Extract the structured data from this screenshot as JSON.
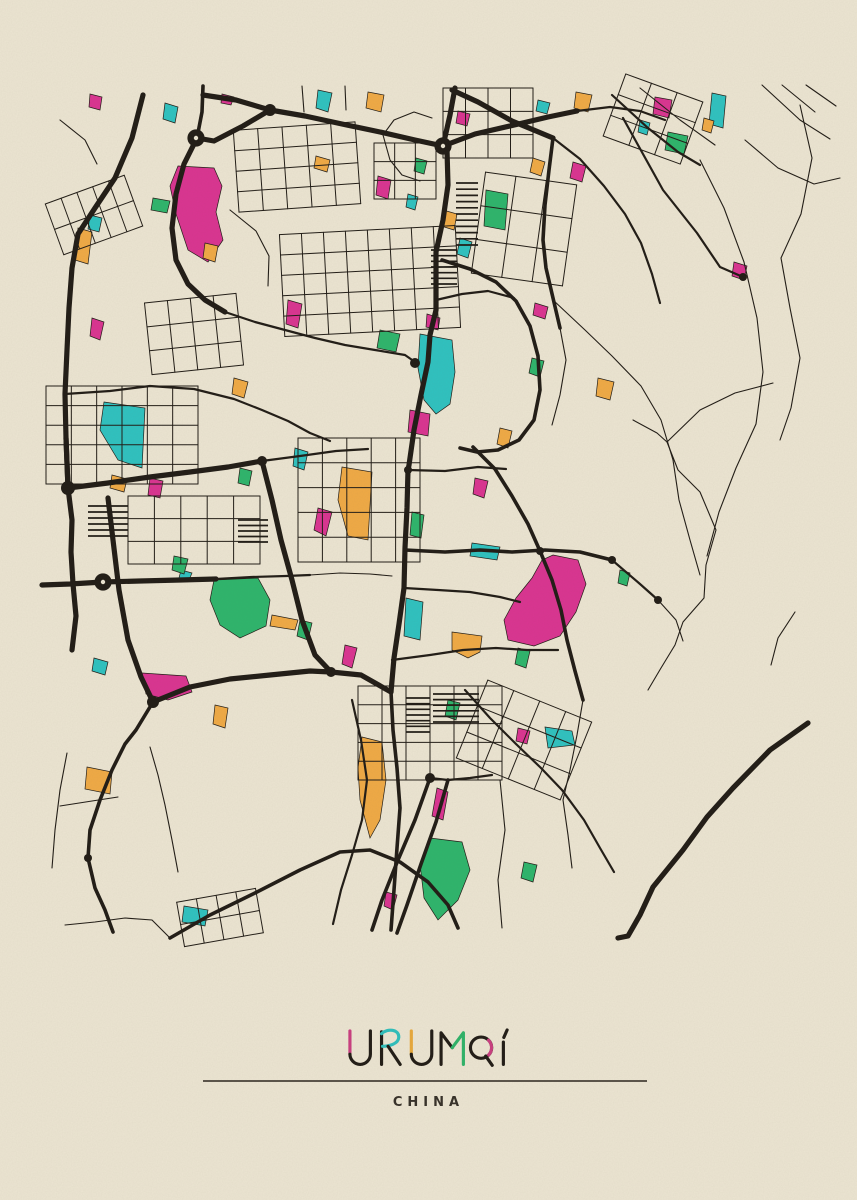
{
  "poster": {
    "title": {
      "text": "URUMQI",
      "letters": [
        {
          "char": "U",
          "accent": "pink"
        },
        {
          "char": "R",
          "accent": "teal"
        },
        {
          "char": "U",
          "accent": "orange"
        },
        {
          "char": "M",
          "accent": "green"
        },
        {
          "char": "Q",
          "accent": "pink"
        },
        {
          "char": "I",
          "accent": "ink"
        }
      ]
    },
    "subtitle": "CHINA",
    "divider": {
      "x1": 203,
      "x2": 647,
      "y": 1081
    }
  },
  "colors": {
    "background": "#ece5d2",
    "ink": "#211c16",
    "pink": "#da3491",
    "teal": "#2fc2c0",
    "orange": "#f0aa45",
    "green": "#2eb56c",
    "divider": "#2a241c",
    "subtitle_text": "#38322a",
    "title_accents": {
      "pink": "#ca3f80",
      "teal": "#2fbfbc",
      "orange": "#e8a93c",
      "green": "#2fb369",
      "ink": "#211c16"
    }
  },
  "map": {
    "region": {
      "x": 40,
      "y": 78,
      "width": 780,
      "height": 867
    },
    "roads": [
      {
        "w": "xl",
        "p": "203,95 236,100 270,110 305,116 342,124 380,132 415,140 443,146"
      },
      {
        "w": "xl",
        "p": "270,110 243,126 214,141 197,138"
      },
      {
        "w": "xl",
        "p": "197,138 184,164 176,194 172,228 176,260 188,284 205,300 225,312"
      },
      {
        "w": "xl",
        "p": "143,95 132,138 115,178 95,208 78,234 72,268 69,308 67,350 65,394 66,438 68,488"
      },
      {
        "w": "xl",
        "p": "455,88 450,115 443,146"
      },
      {
        "w": "xl",
        "p": "443,146 475,134 510,126 548,117 577,111"
      },
      {
        "w": "xl",
        "p": "452,90 478,102 512,121 553,138"
      },
      {
        "w": "xl",
        "p": "447,150 448,185 443,220 436,252 436,285 436,310"
      },
      {
        "w": "xl",
        "p": "436,310 430,335 428,362 421,395 414,430 409,465 408,470"
      },
      {
        "w": "xl",
        "p": "408,470 407,508 405,548 404,588 399,624 394,658 391,692"
      },
      {
        "w": "xl",
        "p": "66,438 68,488 72,520 71,552 73,584 76,616 72,650"
      },
      {
        "w": "xl",
        "p": "68,488 108,483 150,477 190,472 228,467 262,461"
      },
      {
        "w": "xl",
        "p": "42,585 70,584 103,582 140,581 180,580 216,579"
      },
      {
        "w": "xl",
        "p": "262,461 272,500 281,540 292,580 302,620 315,655 331,672"
      },
      {
        "w": "xl",
        "p": "108,498 113,540 119,590 128,640 141,677 153,702"
      },
      {
        "w": "xl",
        "p": "153,702 190,687 230,679 270,675 310,671 331,672 361,675 391,692"
      },
      {
        "w": "xl",
        "p": "808,723 770,750 733,788 707,817 683,850 653,887 640,915 628,936 618,938"
      },
      {
        "w": "l",
        "p": "553,138 549,170 545,205 543,240 546,268 553,298 560,328"
      },
      {
        "w": "l",
        "p": "391,692 393,730 397,768 400,808 397,848 394,890 391,930"
      },
      {
        "w": "l",
        "p": "473,447 495,469 512,496 528,524 540,551"
      },
      {
        "w": "l",
        "p": "405,550 445,552 480,550 512,552 545,550 580,552 612,560"
      },
      {
        "w": "l",
        "p": "540,551 552,580 561,610 567,640 575,671 583,700"
      },
      {
        "w": "l",
        "p": "442,260 470,269 496,282 516,301 530,326 538,356 540,390 534,420 519,440 498,450 477,452 460,448"
      },
      {
        "w": "l",
        "p": "430,778 415,820 398,860 382,900 372,930"
      },
      {
        "w": "l",
        "p": "448,780 436,822 421,864 407,905 397,933"
      },
      {
        "w": "l",
        "p": "153,702 136,730 125,744 112,770 100,800 90,830 88,858 95,888 105,910 113,932"
      },
      {
        "w": "l",
        "p": "170,938 210,915 255,893 300,870 340,852 370,850 400,862 428,882 448,905 458,928"
      },
      {
        "w": "l",
        "p": "203,86 202,112 197,138"
      },
      {
        "w": "m",
        "p": "577,111 610,107 640,111 665,120"
      },
      {
        "w": "m",
        "p": "553,138 580,159 604,186 625,214 641,243 652,274 660,303"
      },
      {
        "w": "m",
        "p": "612,560 640,584 658,600"
      },
      {
        "w": "m",
        "p": "404,588 438,590 470,592 500,597 520,602"
      },
      {
        "w": "m",
        "p": "392,660 430,655 463,650 496,648 527,650 558,650"
      },
      {
        "w": "m",
        "p": "408,470 445,471 478,467 506,469"
      },
      {
        "w": "m",
        "p": "65,394 110,391 150,386 194,389 234,399 262,410 288,421 310,433 330,441"
      },
      {
        "w": "m",
        "p": "430,778 448,780 470,778 492,775"
      },
      {
        "w": "m",
        "p": "352,700 361,740 367,780 362,820 352,855 341,890 333,924"
      },
      {
        "w": "m",
        "p": "465,690 490,718 516,744 541,768 562,790 584,820 600,848 614,872"
      },
      {
        "w": "m",
        "p": "216,579 252,577 286,576 310,575"
      },
      {
        "w": "m",
        "p": "262,461 300,456 336,451 368,449"
      },
      {
        "w": "m",
        "p": "225,312 255,322 285,330 315,338 345,345 375,350 405,355 415,362"
      },
      {
        "w": "m",
        "p": "623,118 663,190 697,233 720,267 743,277"
      },
      {
        "w": "m",
        "p": "612,95 648,128 678,152 700,165"
      },
      {
        "w": "m",
        "p": "436,300 462,294 488,291 514,298"
      },
      {
        "w": "s",
        "p": "773,383 735,393 700,410 667,442 678,470 700,492 716,530 706,565 704,598 683,622 675,645 661,668 648,690"
      },
      {
        "w": "s",
        "p": "700,160 724,208 744,262 757,318 763,372 756,424 736,468 719,512 707,556"
      },
      {
        "w": "s",
        "p": "800,105 812,158 801,214 781,258 790,308 800,358 791,408 780,440"
      },
      {
        "w": "s",
        "p": "633,420 657,433 667,442"
      },
      {
        "w": "s",
        "p": "553,300 585,330 612,356 641,386 661,420 673,460 679,500 690,540 700,575"
      },
      {
        "w": "s",
        "p": "795,612 778,638 771,665"
      },
      {
        "w": "s",
        "p": "745,140 778,168 814,184 840,178"
      },
      {
        "w": "s",
        "p": "762,85 800,120 830,139"
      },
      {
        "w": "s",
        "p": "782,85 815,112"
      },
      {
        "w": "s",
        "p": "806,85 836,106"
      },
      {
        "w": "s",
        "p": "67,753 60,790 55,830 52,868"
      },
      {
        "w": "s",
        "p": "150,747 158,775 165,805 172,840 178,872"
      },
      {
        "w": "s",
        "p": "60,806 92,801 118,797"
      },
      {
        "w": "s",
        "p": "658,600 676,620 683,641"
      },
      {
        "w": "s",
        "p": "500,780 505,830 498,880 502,928"
      },
      {
        "w": "s",
        "p": "583,700 577,735 570,770 563,800 568,835 572,868"
      },
      {
        "w": "s",
        "p": "230,210 256,231 269,256 268,286"
      },
      {
        "w": "s",
        "p": "60,120 85,140 97,164"
      },
      {
        "w": "s",
        "p": "383,135 394,120 414,112 432,118"
      },
      {
        "w": "s",
        "p": "383,135 390,160 402,175 420,181"
      },
      {
        "w": "s",
        "p": "310,575 340,573 370,574 392,576"
      },
      {
        "w": "s",
        "p": "560,328 566,360 560,395 552,425"
      },
      {
        "w": "s",
        "p": "640,88 680,120 715,145"
      },
      {
        "w": "s",
        "p": "65,925 95,922 125,918 152,920 170,938"
      },
      {
        "w": "s",
        "p": "345,86 346,110"
      },
      {
        "w": "s",
        "p": "302,86 304,112"
      }
    ],
    "grids": [
      {
        "x": 282,
        "y": 230,
        "w": 176,
        "h": 102,
        "cols": 8,
        "rows": 5,
        "a": -3
      },
      {
        "x": 443,
        "y": 88,
        "w": 90,
        "h": 70,
        "cols": 4,
        "rows": 3,
        "a": 0
      },
      {
        "x": 46,
        "y": 386,
        "w": 152,
        "h": 98,
        "cols": 6,
        "rows": 5,
        "a": 0
      },
      {
        "x": 128,
        "y": 496,
        "w": 132,
        "h": 68,
        "cols": 5,
        "rows": 3,
        "a": 0
      },
      {
        "x": 358,
        "y": 686,
        "w": 144,
        "h": 94,
        "cols": 6,
        "rows": 5,
        "a": 0
      },
      {
        "x": 612,
        "y": 86,
        "w": 82,
        "h": 66,
        "cols": 3,
        "rows": 3,
        "a": 20
      },
      {
        "x": 52,
        "y": 188,
        "w": 84,
        "h": 54,
        "cols": 5,
        "rows": 2,
        "a": -20
      },
      {
        "x": 236,
        "y": 126,
        "w": 122,
        "h": 82,
        "cols": 5,
        "rows": 4,
        "a": -4
      },
      {
        "x": 298,
        "y": 438,
        "w": 122,
        "h": 124,
        "cols": 5,
        "rows": 5,
        "a": 0
      },
      {
        "x": 468,
        "y": 698,
        "w": 112,
        "h": 84,
        "cols": 4,
        "rows": 3,
        "a": 22
      },
      {
        "x": 148,
        "y": 298,
        "w": 92,
        "h": 72,
        "cols": 4,
        "rows": 3,
        "a": -6
      },
      {
        "x": 478,
        "y": 178,
        "w": 92,
        "h": 102,
        "cols": 3,
        "rows": 3,
        "a": 8
      },
      {
        "x": 374,
        "y": 143,
        "w": 62,
        "h": 56,
        "cols": 3,
        "rows": 3,
        "a": 0
      },
      {
        "x": 180,
        "y": 895,
        "w": 80,
        "h": 45,
        "cols": 4,
        "rows": 2,
        "a": -10
      }
    ],
    "hatches": [
      {
        "x": 456,
        "y": 183,
        "w": 22,
        "h": 62,
        "rows": 10
      },
      {
        "x": 431,
        "y": 250,
        "w": 26,
        "h": 34,
        "rows": 6
      },
      {
        "x": 88,
        "y": 506,
        "w": 40,
        "h": 30,
        "rows": 5
      },
      {
        "x": 433,
        "y": 694,
        "w": 46,
        "h": 28,
        "rows": 5
      },
      {
        "x": 238,
        "y": 520,
        "w": 30,
        "h": 22,
        "rows": 4
      },
      {
        "x": 406,
        "y": 698,
        "w": 24,
        "h": 34,
        "rows": 6
      }
    ],
    "junctions": [
      [
        196,
        138,
        7
      ],
      [
        270,
        110,
        6
      ],
      [
        443,
        146,
        8
      ],
      [
        68,
        488,
        7
      ],
      [
        103,
        582,
        7
      ],
      [
        153,
        702,
        6
      ],
      [
        331,
        672,
        5
      ],
      [
        415,
        363,
        5
      ],
      [
        430,
        778,
        5
      ],
      [
        408,
        470,
        4
      ],
      [
        540,
        551,
        4
      ],
      [
        262,
        461,
        5
      ],
      [
        658,
        600,
        4
      ],
      [
        612,
        560,
        4
      ],
      [
        88,
        858,
        4
      ],
      [
        743,
        277,
        4
      ]
    ],
    "roundabouts": [
      [
        196,
        138
      ],
      [
        103,
        582
      ],
      [
        443,
        146
      ]
    ],
    "patches": [
      {
        "c": "pink",
        "p": "178,166 214,168 222,186 216,212 223,240 208,262 188,250 176,214 170,186"
      },
      {
        "c": "pink",
        "p": "553,555 578,560 586,584 576,612 560,636 534,646 508,640 504,620 516,598 532,578 542,560"
      },
      {
        "c": "pink",
        "p": "142,673 186,676 192,692 168,700 146,694"
      },
      {
        "c": "pink",
        "p": "410,410 430,414 428,436 408,432"
      },
      {
        "c": "pink",
        "p": "427,314 440,318 438,330 426,327"
      },
      {
        "c": "pink",
        "p": "92,318 104,322 100,340 90,336"
      },
      {
        "c": "pink",
        "p": "150,478 163,481 160,498 148,495"
      },
      {
        "c": "pink",
        "p": "288,300 302,304 298,328 286,324"
      },
      {
        "c": "pink",
        "p": "655,97 672,100 669,118 653,114"
      },
      {
        "c": "pink",
        "p": "734,262 747,266 744,280 732,276"
      },
      {
        "c": "pink",
        "p": "90,94 102,97 100,110 89,107"
      },
      {
        "c": "pink",
        "p": "458,111 470,114 467,126 456,123"
      },
      {
        "c": "pink",
        "p": "378,176 391,180 388,199 376,195"
      },
      {
        "c": "pink",
        "p": "437,788 448,792 443,820 432,816"
      },
      {
        "c": "pink",
        "p": "386,892 397,895 393,910 384,906"
      },
      {
        "c": "pink",
        "p": "518,728 530,731 527,744 516,741"
      },
      {
        "c": "pink",
        "p": "475,478 488,481 484,498 473,494"
      },
      {
        "c": "pink",
        "p": "345,645 357,648 352,668 342,664"
      },
      {
        "c": "pink",
        "p": "222,94 234,97 231,105 221,103"
      },
      {
        "c": "pink",
        "p": "318,508 332,512 326,536 314,530"
      },
      {
        "c": "pink",
        "p": "573,162 586,166 582,182 570,178"
      },
      {
        "c": "pink",
        "p": "535,303 548,307 545,319 533,315"
      },
      {
        "c": "teal",
        "p": "104,402 145,408 142,468 118,460 100,430"
      },
      {
        "c": "teal",
        "p": "420,334 452,340 455,372 450,404 436,414 424,400 418,368"
      },
      {
        "c": "teal",
        "p": "545,727 572,731 575,745 548,748"
      },
      {
        "c": "teal",
        "p": "406,598 423,602 420,640 404,636"
      },
      {
        "c": "teal",
        "p": "472,543 500,547 497,560 470,556"
      },
      {
        "c": "teal",
        "p": "712,93 726,96 723,128 709,124"
      },
      {
        "c": "teal",
        "p": "318,90 332,93 328,112 316,108"
      },
      {
        "c": "teal",
        "p": "538,100 550,103 547,114 536,111"
      },
      {
        "c": "teal",
        "p": "184,906 208,910 205,926 182,922"
      },
      {
        "c": "teal",
        "p": "181,570 192,573 189,580 179,578"
      },
      {
        "c": "teal",
        "p": "640,120 650,123 647,135 638,132"
      },
      {
        "c": "teal",
        "p": "90,215 102,218 99,232 88,229"
      },
      {
        "c": "teal",
        "p": "94,658 108,662 105,675 92,671"
      },
      {
        "c": "teal",
        "p": "295,448 308,452 304,470 293,466"
      },
      {
        "c": "teal",
        "p": "460,238 472,242 468,258 457,254"
      },
      {
        "c": "teal",
        "p": "408,194 418,197 415,210 406,207"
      },
      {
        "c": "teal",
        "p": "165,103 178,107 175,123 163,119"
      },
      {
        "c": "green",
        "p": "214,580 258,578 270,600 266,626 240,638 220,625 210,600"
      },
      {
        "c": "green",
        "p": "430,838 462,842 470,870 458,900 438,920 424,898 420,864"
      },
      {
        "c": "green",
        "p": "486,190 508,194 505,230 484,226"
      },
      {
        "c": "green",
        "p": "412,512 424,515 421,538 410,535"
      },
      {
        "c": "green",
        "p": "153,198 170,201 167,213 151,210"
      },
      {
        "c": "green",
        "p": "668,132 688,136 684,154 665,150"
      },
      {
        "c": "green",
        "p": "380,330 400,334 396,352 377,348"
      },
      {
        "c": "green",
        "p": "524,862 537,865 533,882 521,878"
      },
      {
        "c": "green",
        "p": "174,556 188,559 184,574 172,570"
      },
      {
        "c": "green",
        "p": "300,620 312,623 308,640 297,636"
      },
      {
        "c": "green",
        "p": "448,700 460,703 456,720 445,716"
      },
      {
        "c": "green",
        "p": "532,358 544,361 540,377 529,373"
      },
      {
        "c": "green",
        "p": "416,158 427,161 424,174 414,171"
      },
      {
        "c": "green",
        "p": "518,648 530,651 526,668 515,664"
      },
      {
        "c": "green",
        "p": "620,570 630,573 627,586 618,583"
      },
      {
        "c": "green",
        "p": "240,468 252,471 249,486 238,483"
      },
      {
        "c": "orange",
        "p": "342,467 372,472 368,540 348,536 338,500"
      },
      {
        "c": "orange",
        "p": "362,737 382,742 386,780 380,820 370,838 360,800 358,768"
      },
      {
        "c": "orange",
        "p": "78,228 92,232 88,264 75,260"
      },
      {
        "c": "orange",
        "p": "576,92 592,95 588,112 574,108"
      },
      {
        "c": "orange",
        "p": "316,156 330,160 327,172 314,168"
      },
      {
        "c": "orange",
        "p": "704,118 714,121 711,133 702,130"
      },
      {
        "c": "orange",
        "p": "598,378 614,382 610,400 596,396"
      },
      {
        "c": "orange",
        "p": "112,475 127,479 124,492 110,488"
      },
      {
        "c": "orange",
        "p": "443,210 457,214 454,230 441,226"
      },
      {
        "c": "orange",
        "p": "234,378 248,382 244,398 232,394"
      },
      {
        "c": "orange",
        "p": "272,615 298,620 295,630 270,626"
      },
      {
        "c": "orange",
        "p": "533,158 545,162 541,176 530,172"
      },
      {
        "c": "orange",
        "p": "452,632 482,636 480,652 468,658 452,650"
      },
      {
        "c": "orange",
        "p": "368,92 384,95 381,112 366,108"
      },
      {
        "c": "orange",
        "p": "500,428 512,431 508,448 497,444"
      },
      {
        "c": "orange",
        "p": "215,705 228,708 225,728 213,724"
      },
      {
        "c": "orange",
        "p": "87,767 112,772 110,794 85,789"
      },
      {
        "c": "orange",
        "p": "205,243 218,246 215,262 203,258"
      }
    ]
  }
}
